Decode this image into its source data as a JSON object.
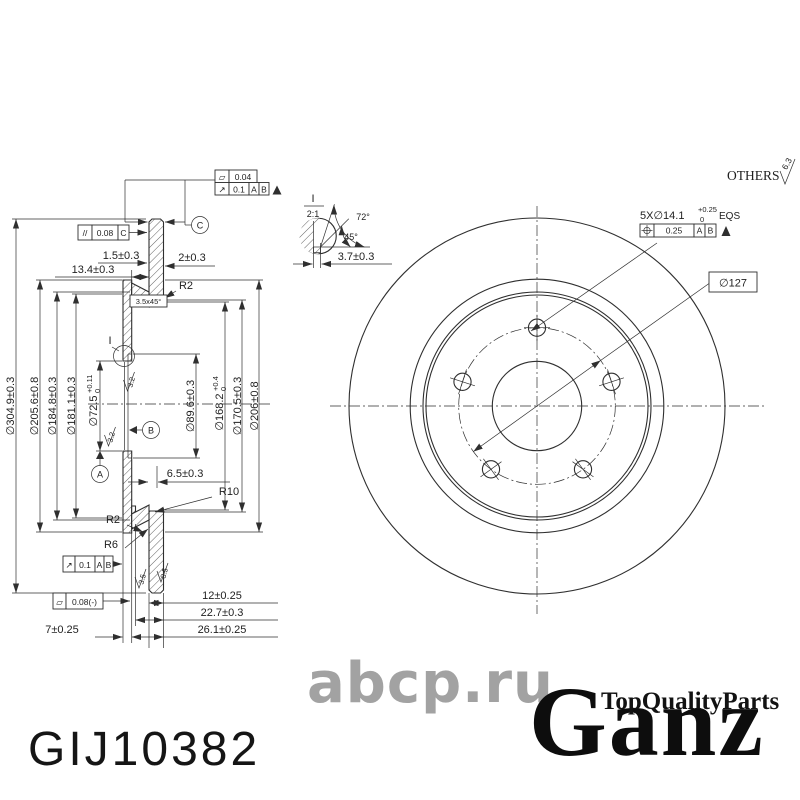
{
  "branding": {
    "part_number": "GIJ10382",
    "watermark": "abcp.ru",
    "brand": "Ganz",
    "tagline": "TopQualityParts"
  },
  "general_note": {
    "others": "OTHERS",
    "roughness": "6.3"
  },
  "symbols": {
    "flatness": "▱",
    "runout": "↗",
    "parallelism": "//"
  },
  "detail": {
    "label": "I",
    "scale": "2:1",
    "angle_72": "72°",
    "angle_45": "45°",
    "groove_width": "3.7±0.3"
  },
  "section": {
    "d304": "∅304.9±0.3",
    "d2056": "∅205.6±0.8",
    "d1848": "∅184.8±0.3",
    "d1811": "∅181.1±0.3",
    "d725": "∅72.5",
    "d725_sup": "+0.11",
    "d725_sub": "0",
    "d896": "∅89.6±0.3",
    "d1682": "∅168.2",
    "d1682_sup": "+0.4",
    "d1682_sub": "0",
    "d1705": "∅170.5±0.3",
    "d206": "∅206±0.8",
    "w15": "1.5±0.3",
    "w2": "2±0.3",
    "w134": "13.4±0.3",
    "chamfer": "3.5x45°",
    "r2_top": "R2",
    "r2_bottom": "R2",
    "r10": "R10",
    "r6": "R6",
    "w65": "6.5±0.3",
    "t12": "12±0.25",
    "t227": "22.7±0.3",
    "t261": "26.1±0.25",
    "t7": "7±0.25",
    "f32a": "3.2",
    "f32b": "3.2",
    "f35a": "3.5",
    "f35b": "3.5",
    "datum_a": "A",
    "datum_b": "B",
    "datum_c": "C"
  },
  "gdt": {
    "flatness_top": "0.04",
    "runout_top": "0.1",
    "runout_top_d1": "A",
    "runout_top_d2": "B",
    "parallelism": "0.08",
    "parallelism_datum": "C",
    "runout_bottom": "0.1",
    "runout_bottom_d1": "A",
    "runout_bottom_d2": "B",
    "flatness_bottom": "0.08(-)",
    "position": "0.25",
    "position_d1": "A",
    "position_d2": "B"
  },
  "front": {
    "holes": "5X∅14.1",
    "holes_sup": "+0.25",
    "holes_sub": "0",
    "holes_eqs": "EQS",
    "bolt_circle": "∅127"
  }
}
